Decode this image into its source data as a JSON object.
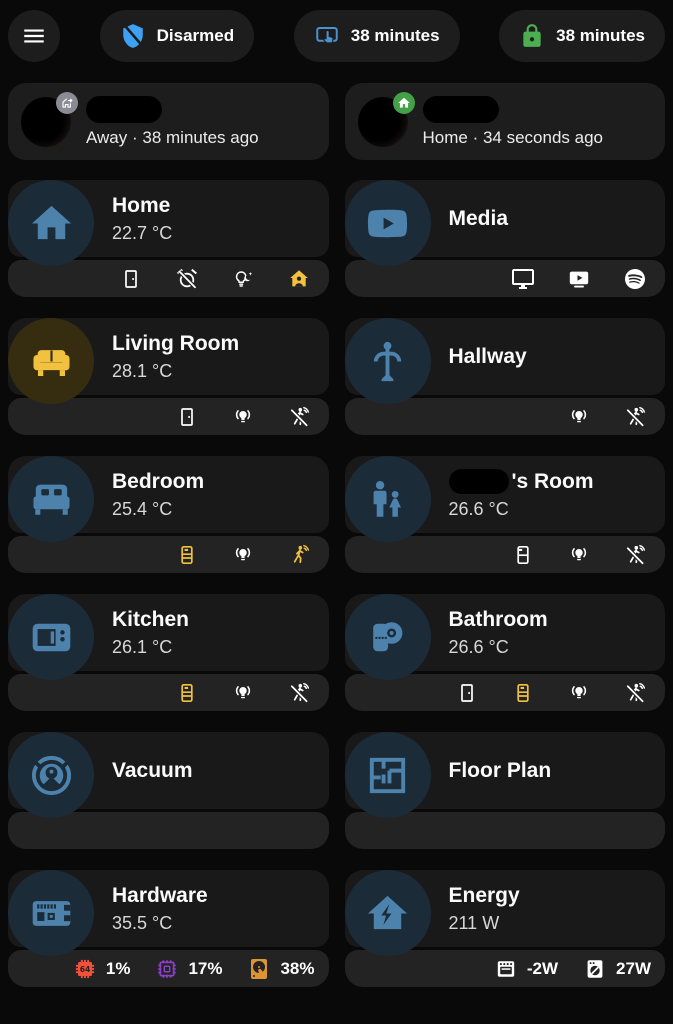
{
  "colors": {
    "page_bg": "#090909",
    "card_bg": "#191919",
    "footer_bg": "#232323",
    "chip_bg": "#1d1d1d",
    "hero_blue": "#4d82ad",
    "hero_blue_tint": "#1c2b38",
    "hero_yellow": "#f1c13f",
    "hero_yellow_tint": "#362d10",
    "white_icon": "#ffffff",
    "shield_blue": "#3ea2f4",
    "tap_blue": "#4b92cf",
    "lock_green": "#4cae50",
    "badge_gray": "#8b8b95",
    "badge_green": "#43a047",
    "cpu_red": "#f1503a",
    "memory_purple": "#8d3fc7",
    "disk_orange": "#dd9433"
  },
  "header": {
    "chips": [
      {
        "icon": "shield-off",
        "icon_color": "#3ea2f4",
        "label": "Disarmed"
      },
      {
        "icon": "gesture-tap",
        "icon_color": "#4b92cf",
        "label": "38 minutes"
      },
      {
        "icon": "lock",
        "icon_color": "#4cae50",
        "label": "38 minutes"
      }
    ]
  },
  "persons": [
    {
      "status": "Away · 38 minutes ago",
      "badge_icon": "home-export",
      "badge_color": "#8b8b95",
      "name_redacted": true
    },
    {
      "status": "Home · 34 seconds ago",
      "badge_icon": "home-solid",
      "badge_color": "#43a047",
      "name_redacted": true
    }
  ],
  "cards": [
    {
      "slug": "home",
      "title": "Home",
      "subtitle": "22.7 °C",
      "icon": "home-solid",
      "icon_color": "#4d82ad",
      "tint": "#1c2b38",
      "footer": [
        {
          "icon": "door",
          "color": "#ffffff"
        },
        {
          "icon": "alarm-off",
          "color": "#ffffff"
        },
        {
          "icon": "lightbulb-night",
          "color": "#ffffff"
        },
        {
          "icon": "home-account",
          "color": "#f1c13f"
        }
      ]
    },
    {
      "slug": "media",
      "title": "Media",
      "icon": "youtube",
      "icon_color": "#4d82ad",
      "tint": "#1c2b38",
      "footer": [
        {
          "icon": "monitor",
          "color": "#ffffff"
        },
        {
          "icon": "youtube-tv",
          "color": "#ffffff"
        },
        {
          "icon": "spotify",
          "color": "#ffffff"
        }
      ]
    },
    {
      "slug": "living-room",
      "title": "Living Room",
      "subtitle": "28.1 °C",
      "icon": "sofa",
      "icon_color": "#f1c13f",
      "tint": "#362d10",
      "footer": [
        {
          "icon": "door",
          "color": "#ffffff"
        },
        {
          "icon": "lightbulb-group",
          "color": "#ffffff"
        },
        {
          "icon": "motion-sensor-off",
          "color": "#ffffff"
        }
      ]
    },
    {
      "slug": "hallway",
      "title": "Hallway",
      "icon": "coat-rack",
      "icon_color": "#4d82ad",
      "tint": "#1c2b38",
      "footer": [
        {
          "icon": "lightbulb-group",
          "color": "#ffffff"
        },
        {
          "icon": "motion-sensor-off",
          "color": "#ffffff"
        }
      ]
    },
    {
      "slug": "bedroom",
      "title": "Bedroom",
      "subtitle": "25.4 °C",
      "icon": "bed",
      "icon_color": "#4d82ad",
      "tint": "#1c2b38",
      "footer": [
        {
          "icon": "radiator",
          "color": "#f1c13f"
        },
        {
          "icon": "lightbulb-group",
          "color": "#ffffff"
        },
        {
          "icon": "motion-sensor",
          "color": "#f1c13f"
        }
      ]
    },
    {
      "slug": "kids-room",
      "title": "'s Room",
      "title_redacted_prefix": true,
      "subtitle": "26.6 °C",
      "icon": "human-male-child",
      "icon_color": "#4d82ad",
      "tint": "#1c2b38",
      "footer": [
        {
          "icon": "radiator-disabled",
          "color": "#ffffff"
        },
        {
          "icon": "lightbulb-group",
          "color": "#ffffff"
        },
        {
          "icon": "motion-sensor-off",
          "color": "#ffffff"
        }
      ]
    },
    {
      "slug": "kitchen",
      "title": "Kitchen",
      "subtitle": "26.1 °C",
      "icon": "microwave",
      "icon_color": "#4d82ad",
      "tint": "#1c2b38",
      "footer": [
        {
          "icon": "radiator",
          "color": "#f1c13f"
        },
        {
          "icon": "lightbulb-group",
          "color": "#ffffff"
        },
        {
          "icon": "motion-sensor-off",
          "color": "#ffffff"
        }
      ]
    },
    {
      "slug": "bathroom",
      "title": "Bathroom",
      "subtitle": "26.6 °C",
      "icon": "paper-roll",
      "icon_color": "#4d82ad",
      "tint": "#1c2b38",
      "footer": [
        {
          "icon": "door",
          "color": "#ffffff"
        },
        {
          "icon": "radiator",
          "color": "#f1c13f"
        },
        {
          "icon": "lightbulb-group",
          "color": "#ffffff"
        },
        {
          "icon": "motion-sensor-off",
          "color": "#ffffff"
        }
      ]
    },
    {
      "slug": "vacuum",
      "title": "Vacuum",
      "icon": "robot-vacuum",
      "icon_color": "#4d82ad",
      "tint": "#1c2b38",
      "footer": []
    },
    {
      "slug": "floor-plan",
      "title": "Floor Plan",
      "icon": "floor-plan",
      "icon_color": "#4d82ad",
      "tint": "#1c2b38",
      "footer": []
    },
    {
      "slug": "hardware",
      "title": "Hardware",
      "subtitle": "35.5 °C",
      "icon": "raspberry-pi",
      "icon_color": "#4d82ad",
      "tint": "#1c2b38",
      "footer": [
        {
          "icon": "cpu-64-bit",
          "color": "#f1503a",
          "label": "1%"
        },
        {
          "icon": "memory",
          "color": "#8d3fc7",
          "label": "17%"
        },
        {
          "icon": "harddisk",
          "color": "#dd9433",
          "label": "38%"
        }
      ]
    },
    {
      "slug": "energy",
      "title": "Energy",
      "subtitle": "211 W",
      "icon": "home-lightning",
      "icon_color": "#4d82ad",
      "tint": "#1c2b38",
      "footer": [
        {
          "icon": "stove",
          "color": "#ffffff",
          "label": "-2W"
        },
        {
          "icon": "washing-machine",
          "color": "#ffffff",
          "label": "27W"
        }
      ]
    }
  ]
}
